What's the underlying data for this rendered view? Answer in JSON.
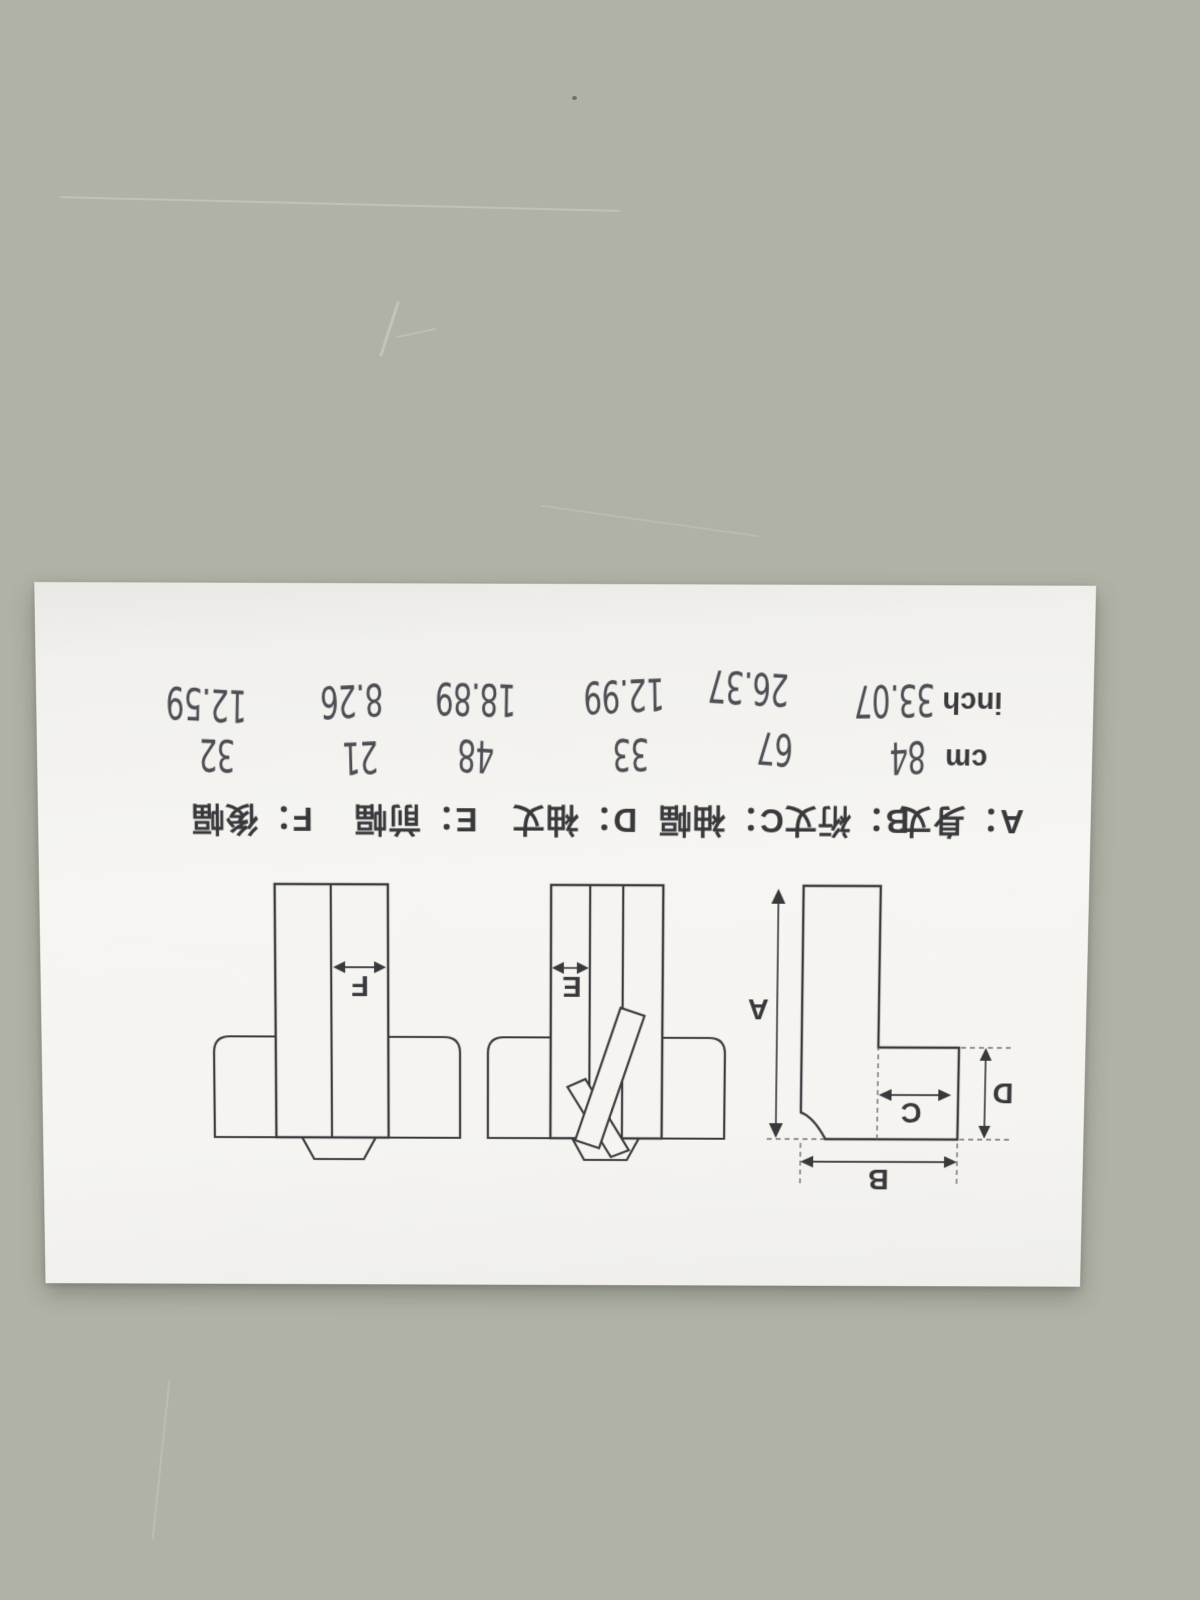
{
  "photo": {
    "description_colors": {
      "table": "#b0b2a6",
      "paper": "#f5f4f1",
      "ink": "#39383b",
      "pen": "#4d4d54"
    },
    "paper": {
      "units": {
        "cm": "cm",
        "inch": "inch"
      },
      "columns": [
        {
          "id": "A",
          "label": "A：身丈",
          "cm": "84",
          "inch": "33.07"
        },
        {
          "id": "B",
          "label": "B：裄丈",
          "cm": "67",
          "inch": "26.37"
        },
        {
          "id": "C",
          "label": "C：袖幅",
          "cm": "33",
          "inch": "12.99"
        },
        {
          "id": "D",
          "label": "D：袖丈",
          "cm": "48",
          "inch": "18.89"
        },
        {
          "id": "E",
          "label": "E：前幅",
          "cm": "21",
          "inch": "8.26"
        },
        {
          "id": "F",
          "label": "F：後幅",
          "cm": "32",
          "inch": "12.59"
        }
      ],
      "diagrams": {
        "letters": {
          "a": "A",
          "b": "B",
          "c": "C",
          "d": "D",
          "e": "E",
          "f": "F"
        }
      }
    }
  }
}
